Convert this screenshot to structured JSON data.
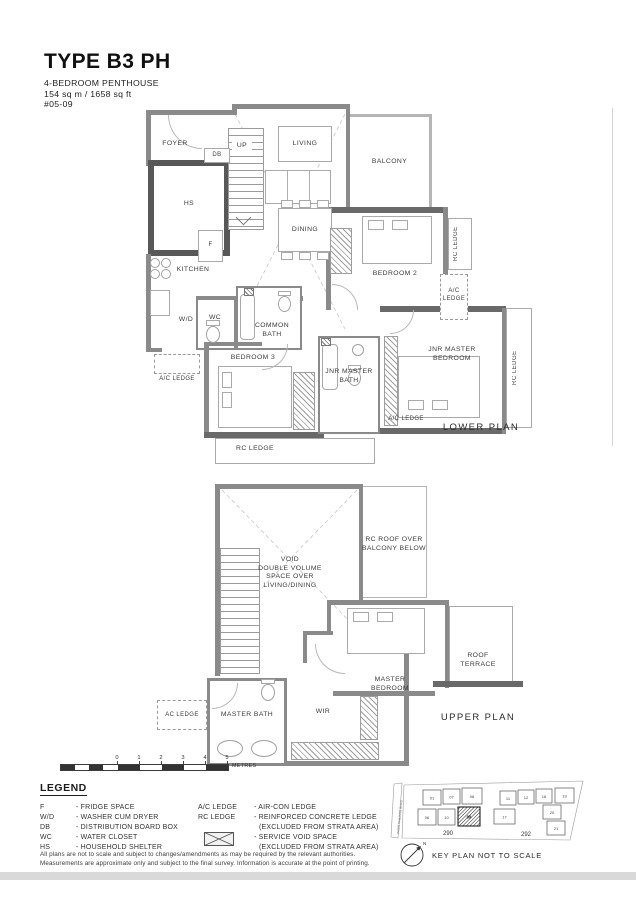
{
  "header": {
    "title": "TYPE B3 PH",
    "subtitle": "4-BEDROOM PENTHOUSE",
    "area": "154 sq m / 1658 sq ft",
    "unit_no": "#05-09"
  },
  "lower_plan": {
    "caption": "LOWER PLAN",
    "labels": {
      "foyer": "FOYER",
      "db": "DB",
      "up": "UP",
      "living": "LIVING",
      "balcony": "BALCONY",
      "hs": "HS",
      "fridge": "F",
      "dining": "DINING",
      "kitchen": "KITCHEN",
      "bedroom2": "BEDROOM 2",
      "rc_ledge_right": "RC LEDGE",
      "ac_ledge_right": "A/C\nLEDGE",
      "wc": "WC",
      "wd": "W/D",
      "common_bath": "COMMON\nBATH",
      "ac_ledge_left": "A/C LEDGE",
      "bedroom3": "BEDROOM 3",
      "jnr_master_bath": "JNR MASTER\nBATH",
      "jnr_master_bedroom": "JNR MASTER\nBEDROOM",
      "rc_ledge_far_right": "RC LEDGE",
      "ac_ledge_bottom": "A/C LEDGE",
      "rc_ledge_bottom": "RC LEDGE"
    }
  },
  "upper_plan": {
    "caption": "UPPER PLAN",
    "labels": {
      "void": "VOID\nDOUBLE VOLUME\nSPACE OVER\nLIVING/DINING",
      "rc_roof": "RC ROOF OVER\nBALCONY BELOW",
      "roof_terrace": "ROOF\nTERRACE",
      "master_bedroom": "MASTER\nBEDROOM",
      "ac_ledge": "AC LEDGE",
      "master_bath": "MASTER BATH",
      "wir": "WIR"
    }
  },
  "scale_bar": {
    "ticks": [
      "0",
      "1",
      "2",
      "3",
      "4",
      "5"
    ],
    "unit": "METRES"
  },
  "legend": {
    "title": "LEGEND",
    "abbreviations": [
      {
        "abbr": "F",
        "desc": "- FRIDGE SPACE"
      },
      {
        "abbr": "W/D",
        "desc": "- WASHER CUM DRYER"
      },
      {
        "abbr": "DB",
        "desc": "- DISTRIBUTION BOARD BOX"
      },
      {
        "abbr": "WC",
        "desc": "- WATER CLOSET"
      },
      {
        "abbr": "HS",
        "desc": "- HOUSEHOLD SHELTER"
      }
    ],
    "ac_row": {
      "abbr": "A/C LEDGE",
      "desc": "- AIR-CON LEDGE"
    },
    "rc_row": {
      "abbr": "RC LEDGE",
      "desc": "- REINFORCED CONCRETE LEDGE",
      "desc2": "(EXCLUDED FROM STRATA AREA)"
    },
    "void_row": {
      "desc": "- SERVICE VOID SPACE",
      "desc2": "(EXCLUDED FROM STRATA AREA)"
    }
  },
  "disclaimer": {
    "line1": "All plans are not to scale and subject to changes/amendments as may be required by the relevant authorities.",
    "line2": "Measurements are approximate only and subject to the final survey. Information is accurate at the point of printing."
  },
  "key_plan": {
    "caption": "KEY PLAN NOT TO SCALE",
    "north_label": "N",
    "road_label": "PASIR PANJANG ROAD",
    "block290": {
      "label": "290",
      "units": [
        "01",
        "07",
        "08",
        "06",
        "10",
        "09"
      ],
      "highlighted_unit": "09"
    },
    "block292": {
      "label": "292",
      "units": [
        "11",
        "12",
        "18",
        "19",
        "17",
        "20",
        "21"
      ]
    }
  }
}
